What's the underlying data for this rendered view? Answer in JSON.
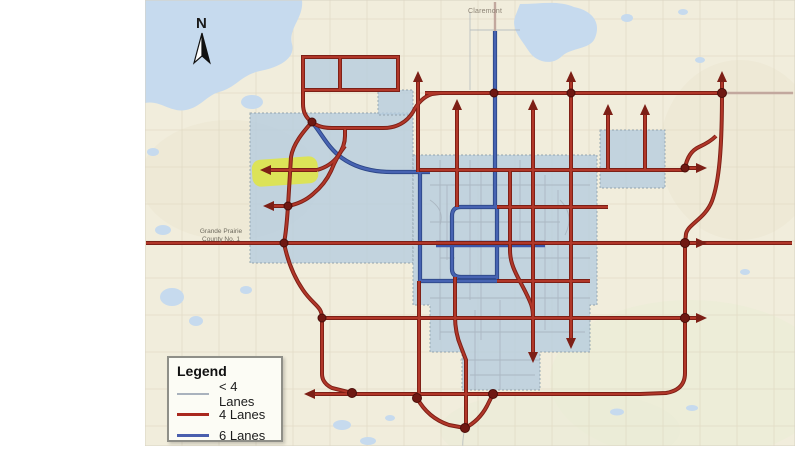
{
  "map": {
    "title": "Road network lane classification map",
    "north_label": "N",
    "place_labels": {
      "claremont": "Claremont",
      "county_line1": "Grande Prairie",
      "county_line2": "County No. 1"
    },
    "highlight": {
      "description": "yellow highlighted road segment with westbound arrow",
      "color": "#e2e63b"
    },
    "colors": {
      "map_background": "#f1eddc",
      "water": "#c6daee",
      "city_boundary_fill": "#b7cdde",
      "road_4_lanes": "#b13729",
      "road_6_lanes": "#4763b2",
      "road_lt4_lanes": "#9fa9b4",
      "junction_dot": "#6f1812",
      "faded_highway": "#c2a89e"
    }
  },
  "legend": {
    "title": "Legend",
    "items": [
      {
        "label": "< 4 Lanes",
        "color": "#a9b2bd"
      },
      {
        "label": "4 Lanes",
        "color": "#a9281e"
      },
      {
        "label": "6 Lanes",
        "color": "#4a5fae"
      }
    ]
  }
}
